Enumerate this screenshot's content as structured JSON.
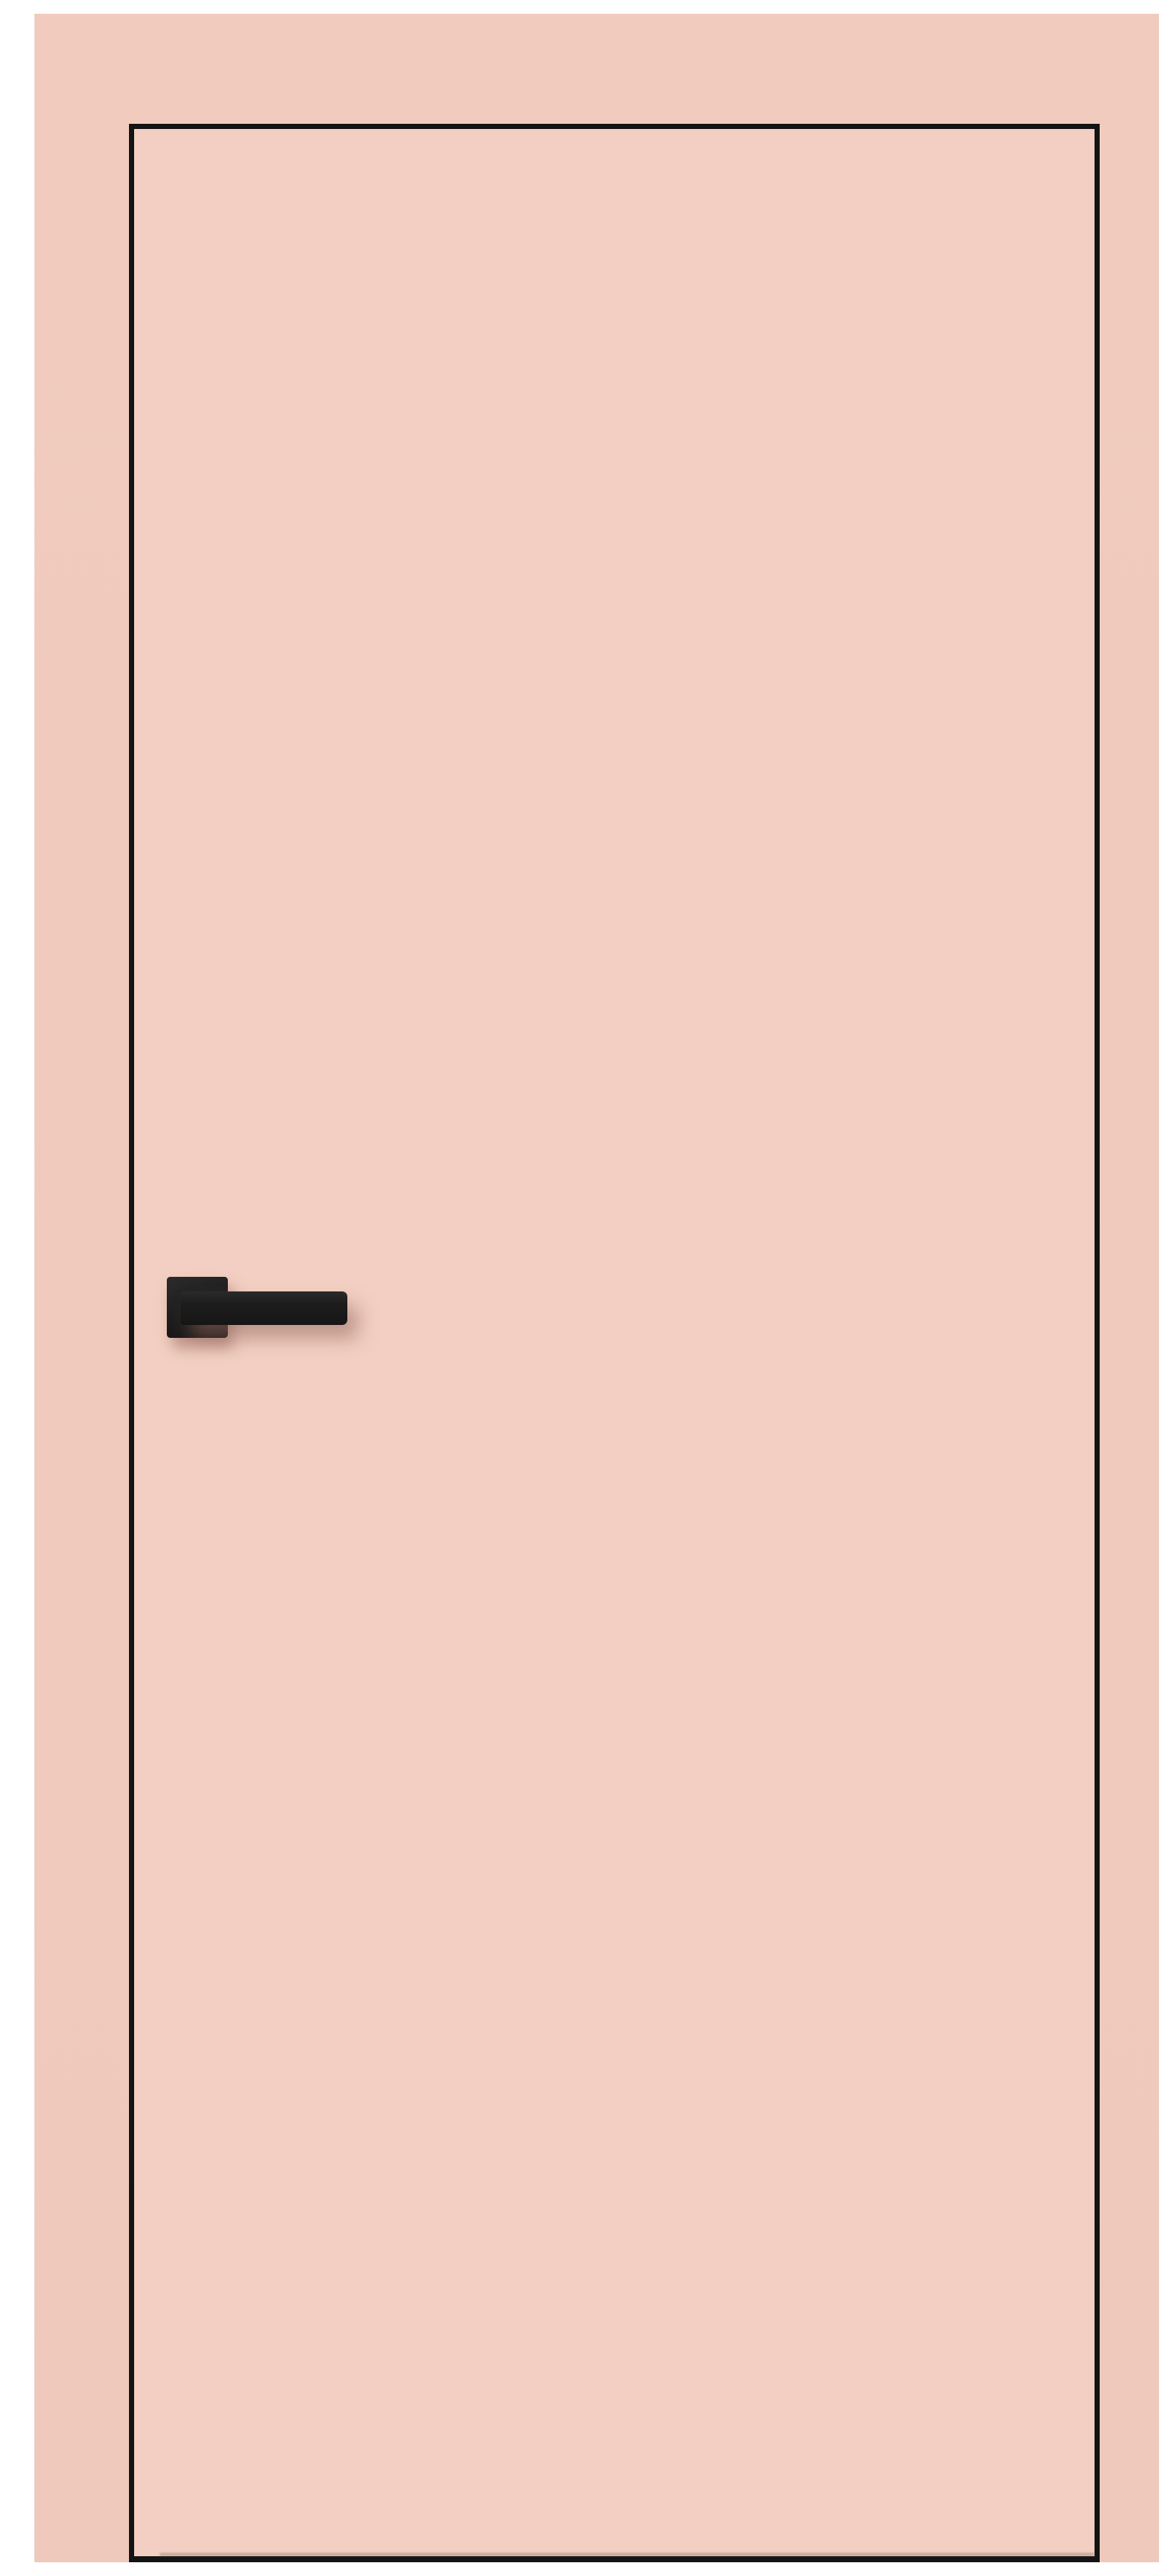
{
  "scene": {
    "label": "Blush pink flush interior door with black outline and matte black square-rosette lever handle on a matching pink wall",
    "door": {
      "style": "flush, frameless look with thin dark edge outline",
      "handle_side": "left",
      "handle_vertical_position": "mid-height"
    },
    "handle": {
      "type": "lever on square rosette",
      "finish": "matte black",
      "orientation": "horizontal, pointing right"
    }
  },
  "colors": {
    "wall-bg": "#f1ccbe",
    "wall-bg-lower": "#efc9bb",
    "door-face": "#f2cfc2",
    "door-outline": "#141414",
    "handle-base": "#1d1d1d",
    "handle-highlight": "#2b2b2b",
    "handle-shadow": "rgba(150, 104, 92, 0.55)"
  }
}
